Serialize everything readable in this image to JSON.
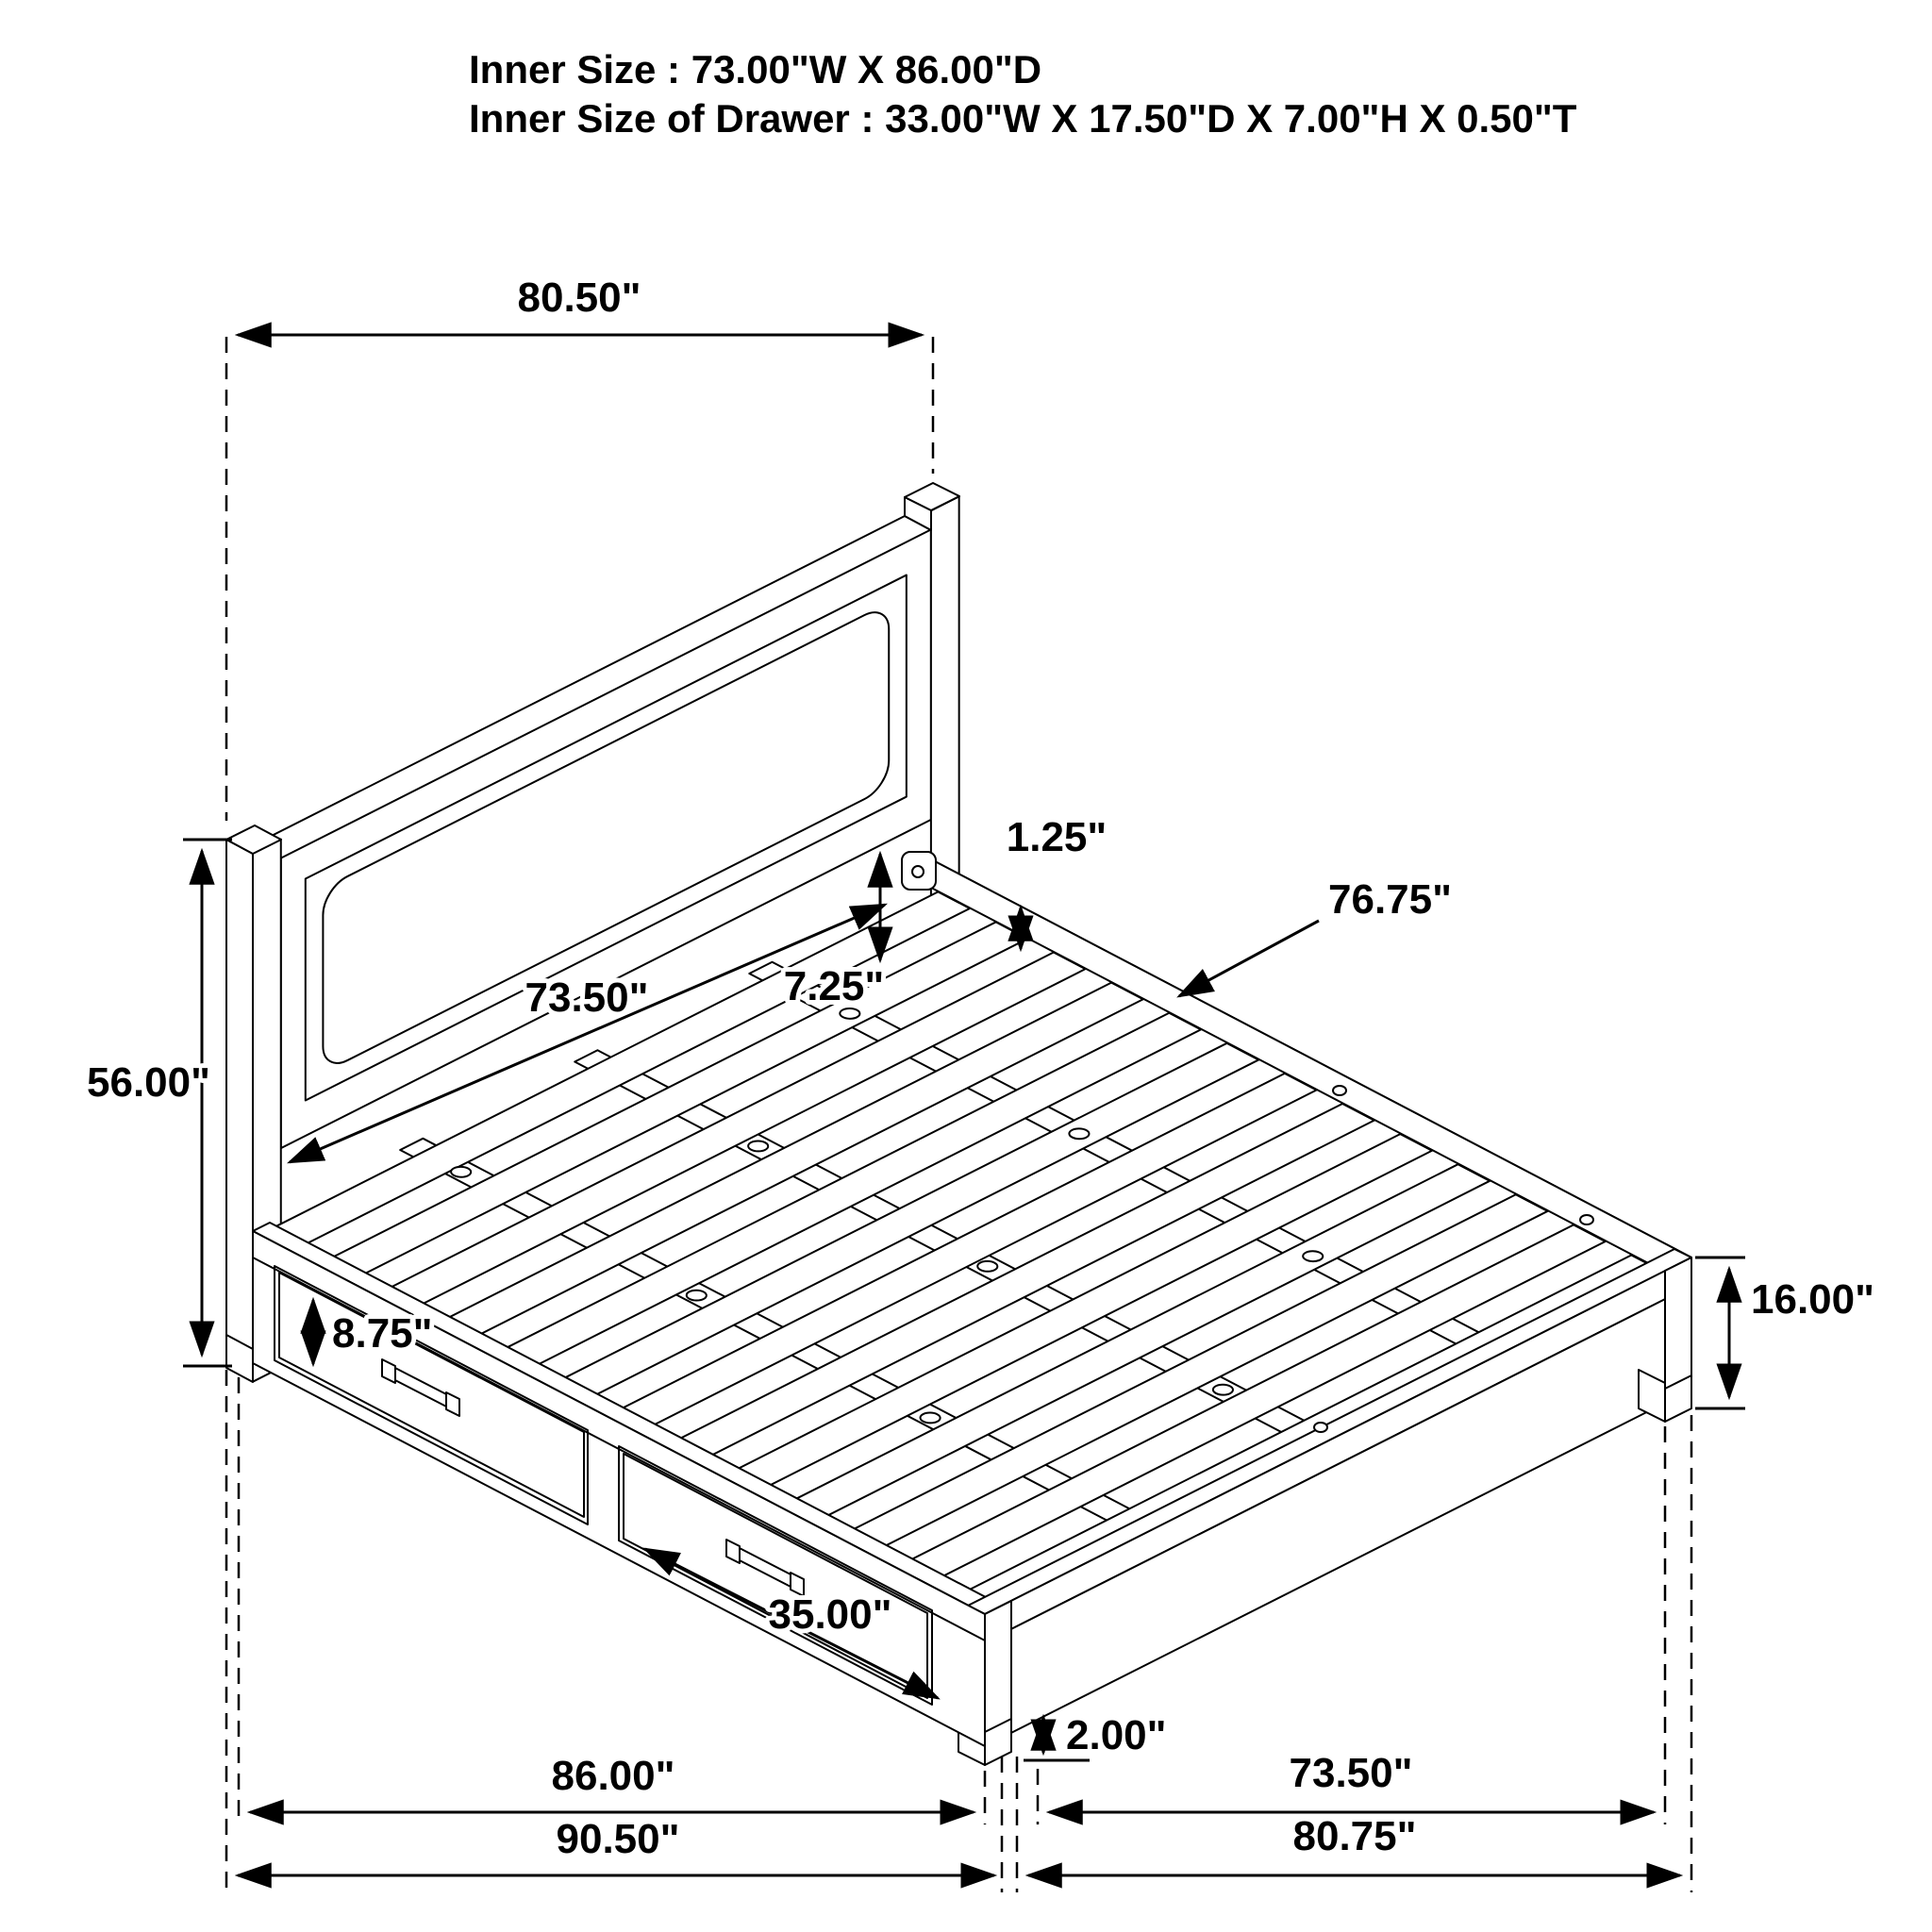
{
  "title": "Storage bed dimension diagram",
  "header": {
    "line1": "Inner Size : 73.00\"W X 86.00\"D",
    "line2": "Inner Size of Drawer : 33.00\"W X 17.50\"D X 7.00\"H X 0.50\"T"
  },
  "dimensions": {
    "headboard_width": "80.50\"",
    "headboard_height": "56.00\"",
    "headboard_inner_width": "73.50\"",
    "panel_to_slat_gap": "7.25\"",
    "rail_lip": "1.25\"",
    "slat_length": "76.75\"",
    "drawer_front_height": "8.75\"",
    "drawer_width": "35.00\"",
    "platform_height": "16.00\"",
    "floor_clearance": "2.00\"",
    "side_rail_length": "86.00\"",
    "overall_length": "90.50\"",
    "footboard_inner_width": "73.50\"",
    "overall_width": "80.75\""
  },
  "colors": {
    "line": "#000000",
    "background": "#ffffff"
  }
}
